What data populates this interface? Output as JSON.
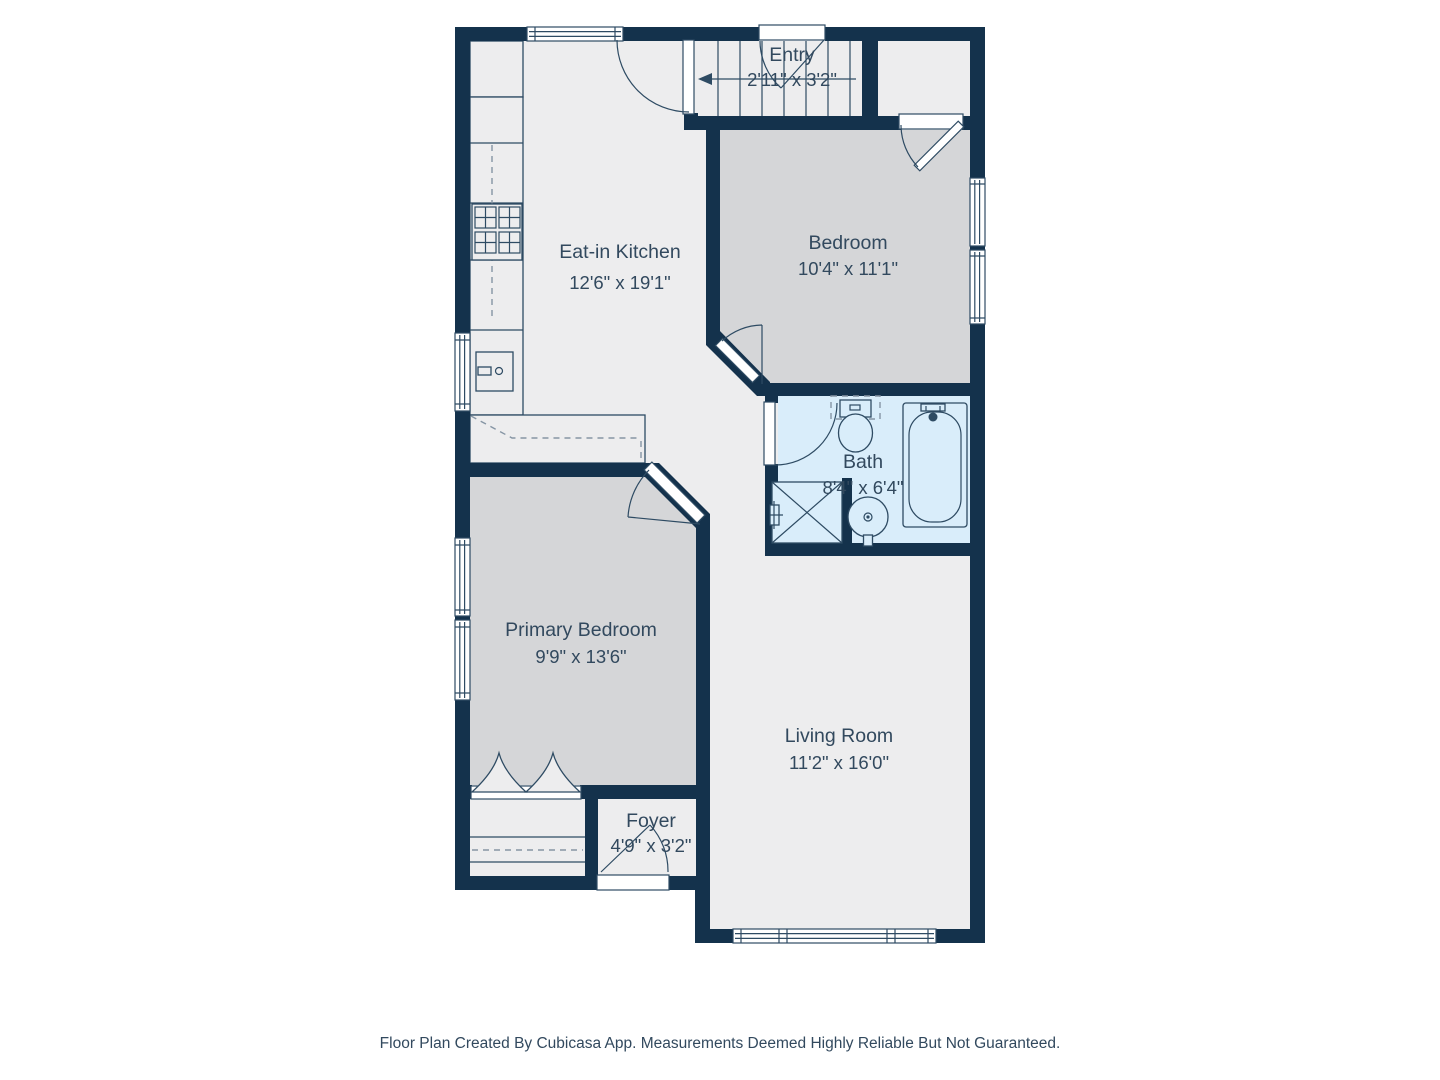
{
  "colors": {
    "wall": "#14324c",
    "floor": "#ededee",
    "floor_bedroom": "#d5d6d8",
    "floor_bath": "#d9edfa",
    "line": "#2e4b63",
    "dash": "#8695a4",
    "text": "#32495e",
    "bg": "#ffffff"
  },
  "rooms": {
    "entry": {
      "name": "Entry",
      "dims": "2'11\" x 3'2\""
    },
    "bedroom": {
      "name": "Bedroom",
      "dims": "10'4\" x 11'1\""
    },
    "kitchen": {
      "name": "Eat-in Kitchen",
      "dims": "12'6\" x 19'1\""
    },
    "bath": {
      "name": "Bath",
      "dims": "8'4\" x 6'4\""
    },
    "primary_bedroom": {
      "name": "Primary Bedroom",
      "dims": "9'9\" x 13'6\""
    },
    "living_room": {
      "name": "Living Room",
      "dims": "11'2\" x 16'0\""
    },
    "foyer": {
      "name": "Foyer",
      "dims": "4'9\" x 3'2\""
    }
  },
  "footer": {
    "text": "Floor Plan Created By Cubicasa App. Measurements Deemed Highly Reliable But Not Guaranteed."
  }
}
